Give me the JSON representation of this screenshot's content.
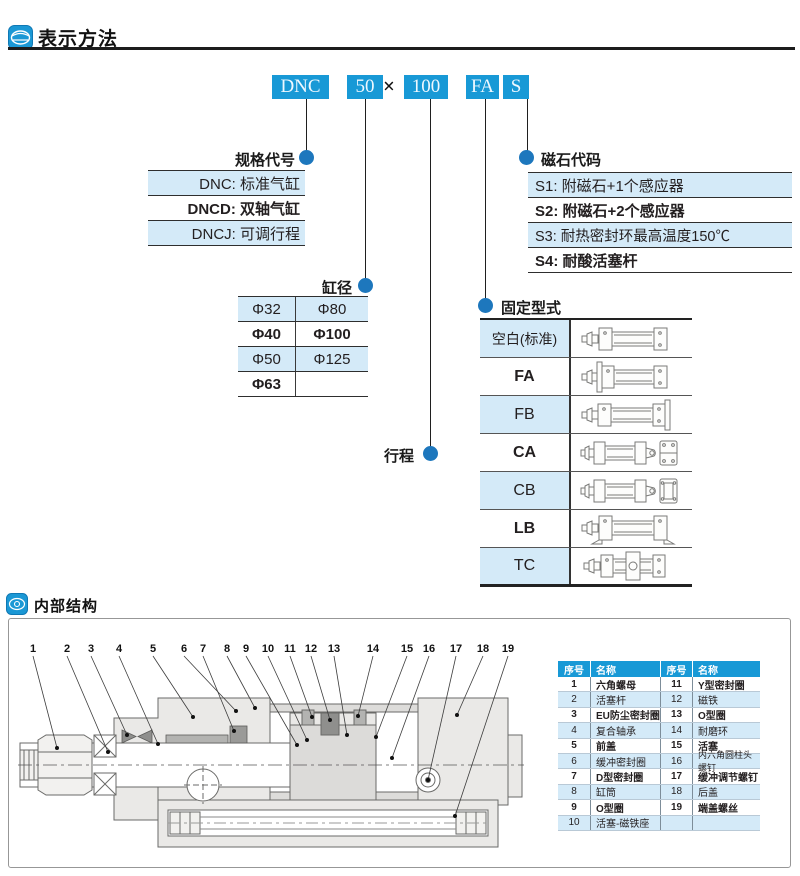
{
  "sections": {
    "method_title": "表示方法",
    "structure_title": "内部结构"
  },
  "order_code": {
    "boxes": [
      "DNC",
      "50",
      "100",
      "FA",
      "S"
    ],
    "multiply": "×"
  },
  "spec_code": {
    "label": "规格代号",
    "rows": [
      "DNC: 标准气缸",
      "DNCD: 双轴气缸",
      "DNCJ: 可调行程"
    ]
  },
  "magnet_code": {
    "label": "磁石代码",
    "rows": [
      "S1: 附磁石+1个感应器",
      "S2: 附磁石+2个感应器",
      "S3: 耐热密封环最高温度150℃",
      "S4: 耐酸活塞杆"
    ]
  },
  "bore": {
    "label": "缸径",
    "rows": [
      [
        "Φ32",
        "Φ80"
      ],
      [
        "Φ40",
        "Φ100"
      ],
      [
        "Φ50",
        "Φ125"
      ],
      [
        "Φ63",
        ""
      ]
    ]
  },
  "stroke": {
    "label": "行程"
  },
  "mounting": {
    "label": "固定型式",
    "types": [
      "空白(标准)",
      "FA",
      "FB",
      "CA",
      "CB",
      "LB",
      "TC"
    ]
  },
  "parts_table": {
    "headers": [
      "序号",
      "名称",
      "序号",
      "名称"
    ],
    "rows": [
      [
        "1",
        "六角螺母",
        "11",
        "Y型密封圈"
      ],
      [
        "2",
        "活塞杆",
        "12",
        "磁铁"
      ],
      [
        "3",
        "EU防尘密封圈",
        "13",
        "O型圈"
      ],
      [
        "4",
        "复合轴承",
        "14",
        "耐磨环"
      ],
      [
        "5",
        "前盖",
        "15",
        "活塞"
      ],
      [
        "6",
        "缓冲密封圈",
        "16",
        "内六角圆柱头螺钉"
      ],
      [
        "7",
        "D型密封圈",
        "17",
        "缓冲调节螺钉"
      ],
      [
        "8",
        "缸筒",
        "18",
        "后盖"
      ],
      [
        "9",
        "O型圈",
        "19",
        "端盖螺丝"
      ],
      [
        "10",
        "活塞-磁铁座",
        "",
        ""
      ]
    ]
  },
  "diagram": {
    "callouts": [
      "1",
      "2",
      "3",
      "4",
      "5",
      "6",
      "7",
      "8",
      "9",
      "10",
      "11",
      "12",
      "13",
      "14",
      "15",
      "16",
      "17",
      "18",
      "19"
    ]
  },
  "colors": {
    "accent_blue": "#1899d6",
    "dot_blue": "#1d77bd",
    "row_light_blue": "#d4eaf8",
    "line_dark": "#1f1f1f"
  }
}
